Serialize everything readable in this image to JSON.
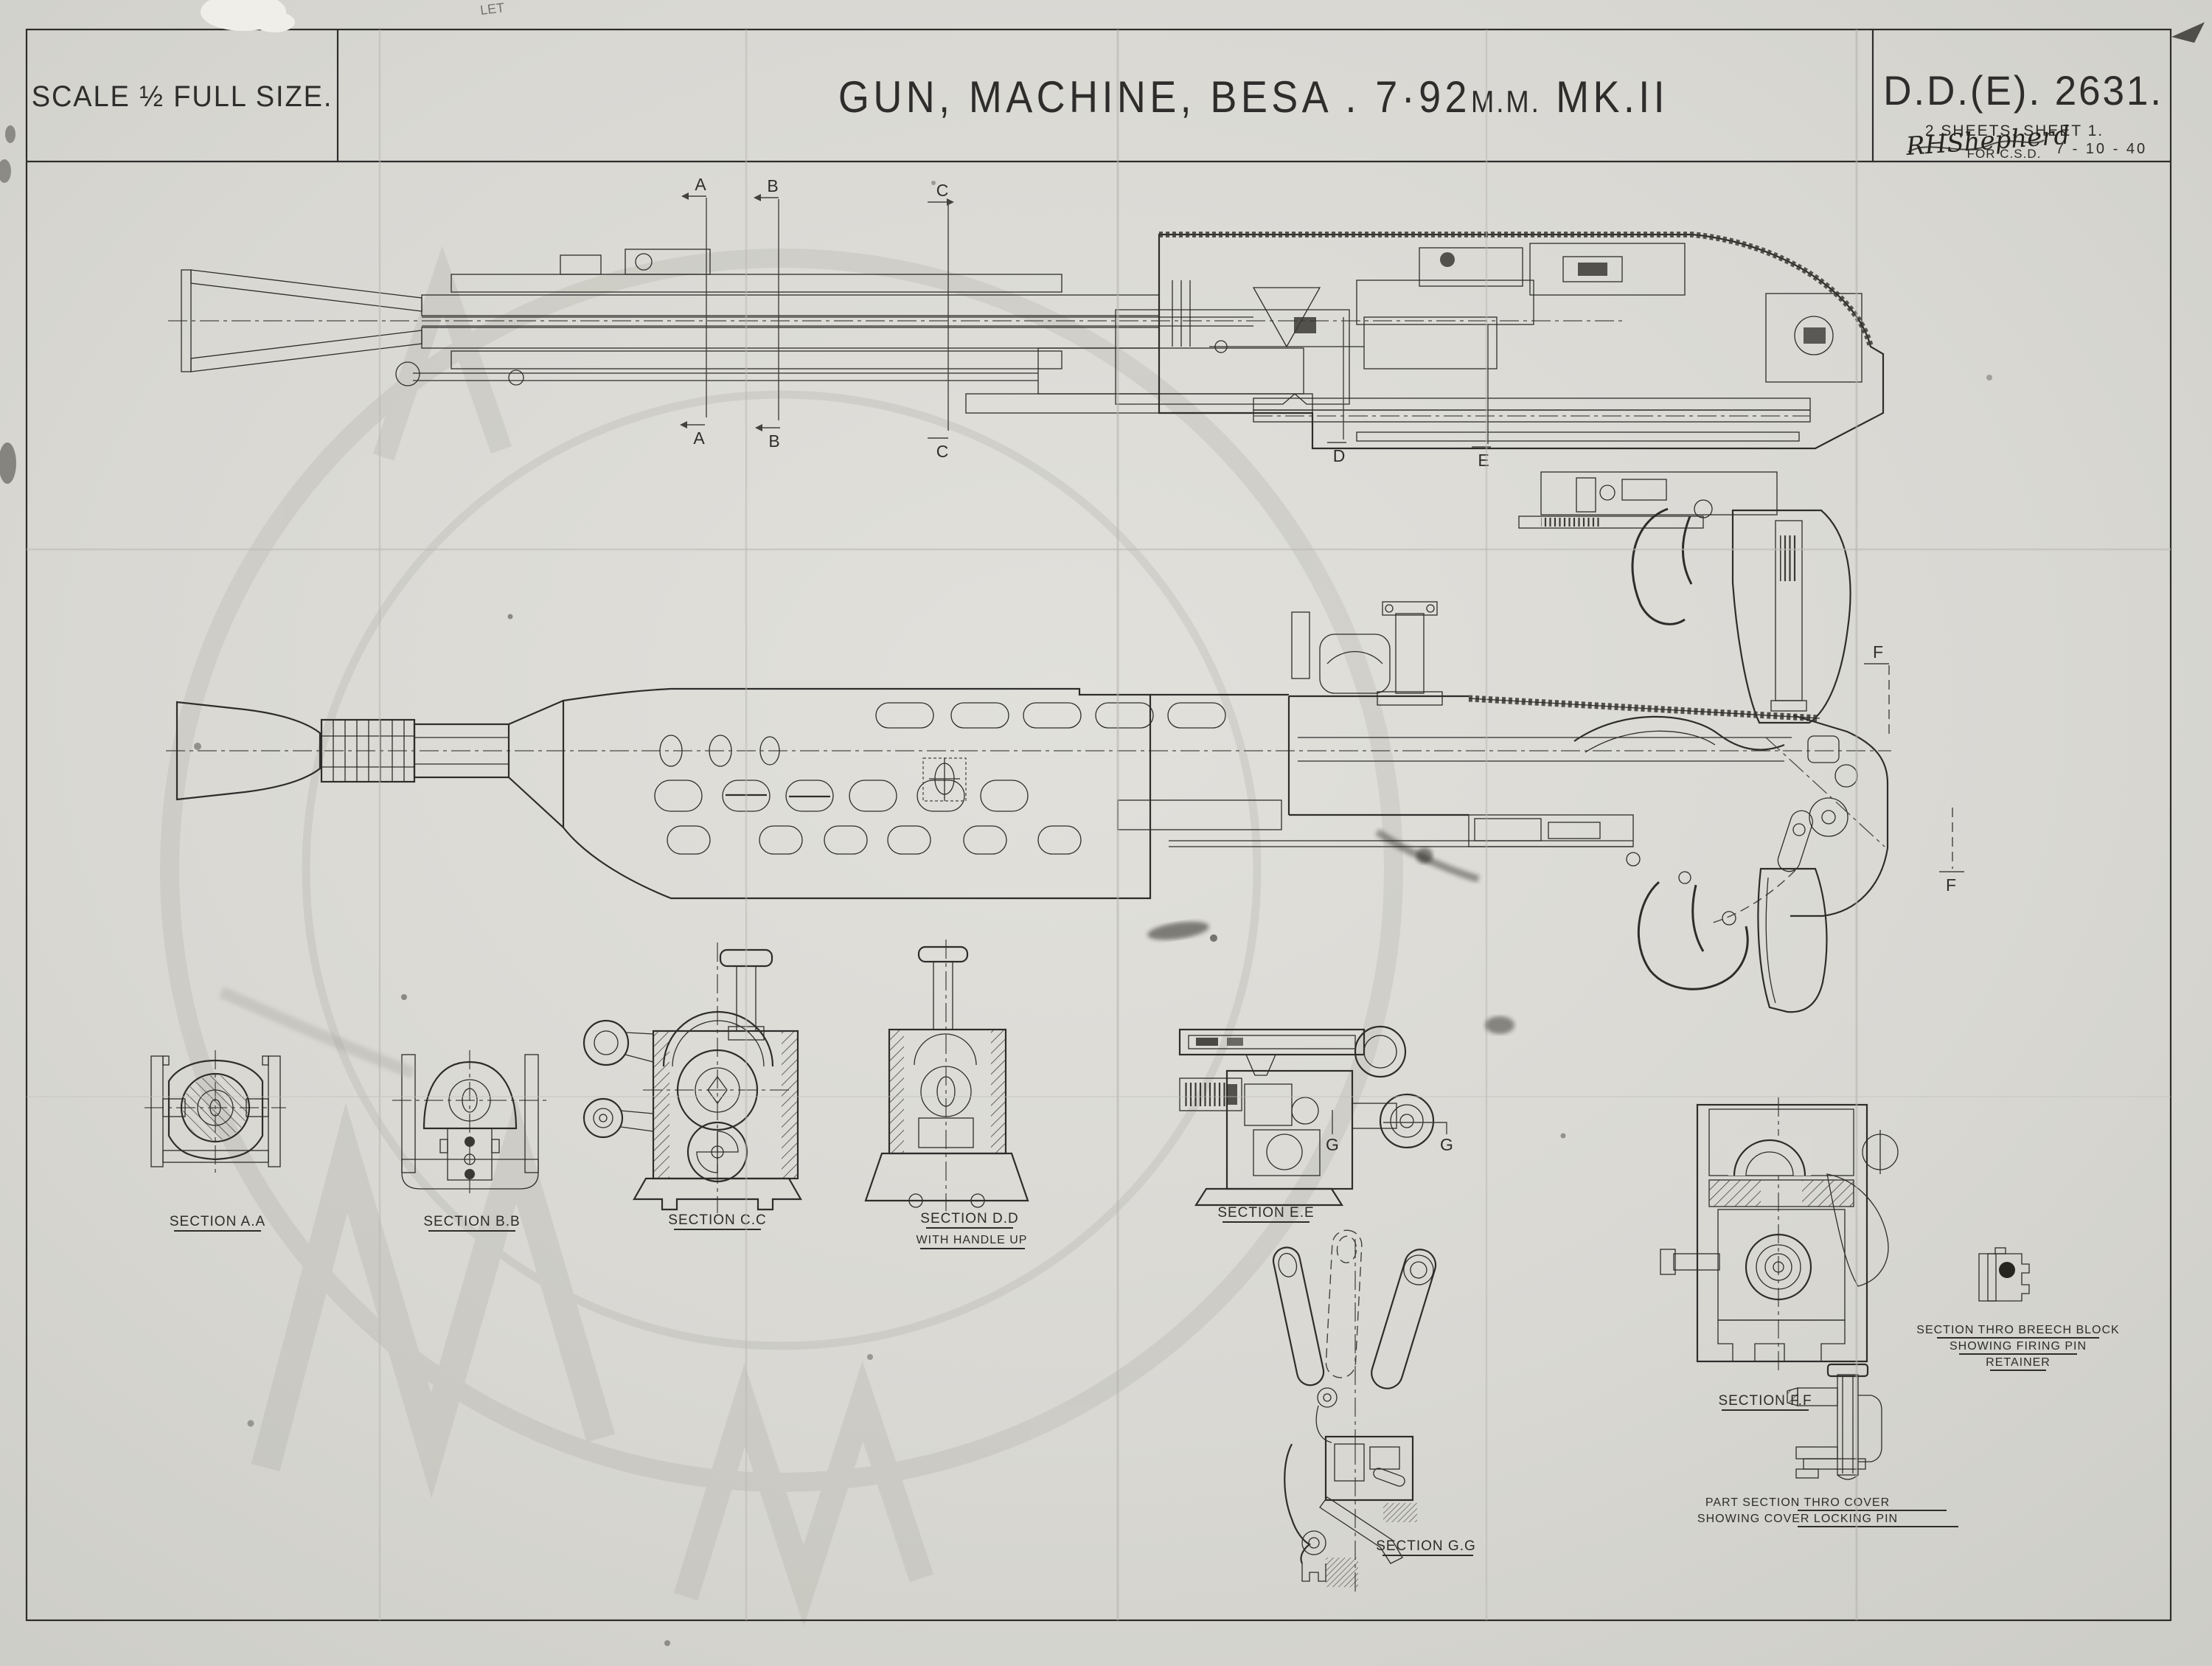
{
  "sheet": {
    "scale_label": "SCALE ½ FULL SIZE.",
    "title": {
      "part1": "GUN, MACHINE, BESA . 7·92",
      "part2": "M.M.",
      "part3": " MK.II"
    },
    "drawing_number": "D.D.(E). 2631.",
    "sheet_note": "2 SHEETS, SHEET 1.",
    "approval": {
      "signature": "RHShepherd",
      "for_line": "FOR C.S.D.",
      "date": "7 - 10 - 40"
    },
    "pencil_note": "LET"
  },
  "markers": {
    "A": "A",
    "B": "B",
    "C": "C",
    "D": "D",
    "E": "E",
    "F": "F",
    "G": "G"
  },
  "sections": [
    {
      "label": "SECTION A.A"
    },
    {
      "label": "SECTION B.B"
    },
    {
      "label": "SECTION C.C"
    },
    {
      "label": "SECTION D.D",
      "sublabel": "WITH HANDLE UP"
    },
    {
      "label": "SECTION E.E"
    },
    {
      "label": "SECTION F.F"
    },
    {
      "label": "SECTION G.G"
    }
  ],
  "details": [
    {
      "lines": [
        "SECTION THRO BREECH BLOCK",
        "SHOWING FIRING PIN",
        "RETAINER"
      ]
    },
    {
      "lines": [
        "PART SECTION THRO COVER",
        "SHOWING COVER LOCKING PIN"
      ]
    }
  ],
  "colors": {
    "paper": "#dad9d4",
    "ink": "#2e2d2b"
  }
}
